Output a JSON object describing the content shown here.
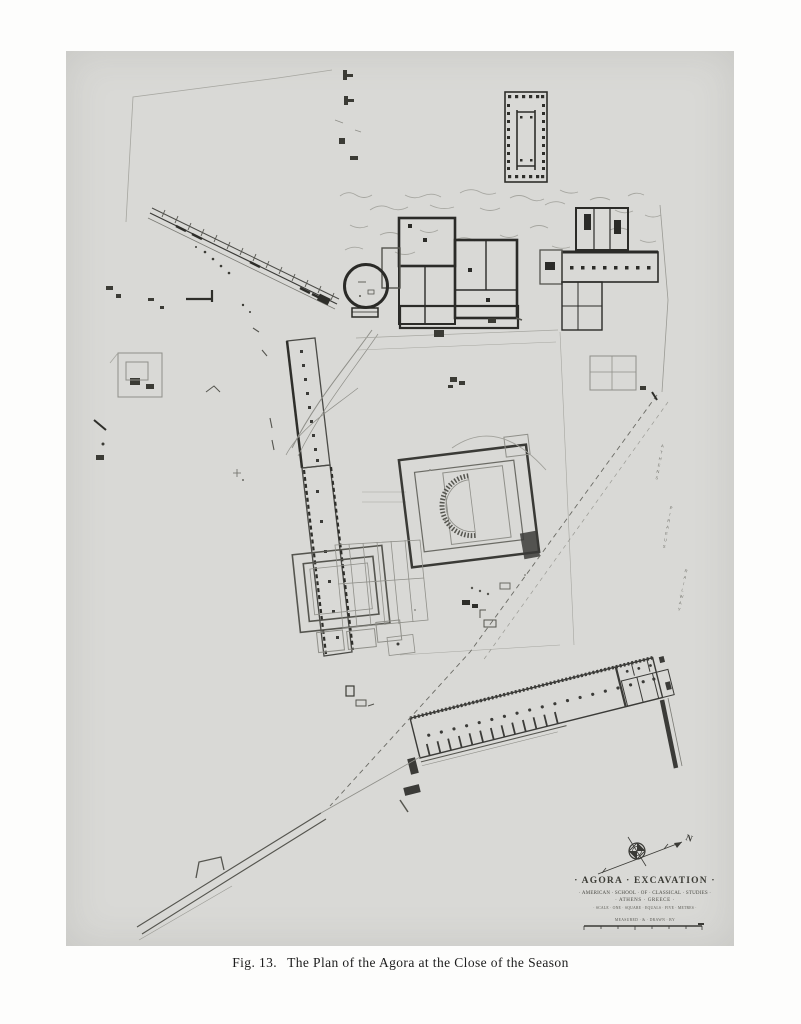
{
  "figure": {
    "fig_label": "Fig. 13.",
    "caption": "The Plan of the Agora at the Close of the Season"
  },
  "title_block": {
    "title": "· AGORA · EXCAVATION ·",
    "institution": "· AMERICAN · SCHOOL · OF · CLASSICAL · STUDIES ·",
    "location": "· ATHENS · GREECE ·",
    "scale_note": "· SCALE · ONE · SQUARE · EQUALS · FIVE · METRES ·",
    "credit": "MEASURED · & · DRAWN · BY"
  },
  "compass": {
    "north_label": "N"
  },
  "street_label": {
    "word1": "ATHENS",
    "word2": "PIRAEUS",
    "word3": "RAILWAY"
  },
  "colors": {
    "page_background": "#fdfdfc",
    "plate_background": "#d9d9d6",
    "ink_dark": "#2e2e2a",
    "ink_mid": "#55554f",
    "ink_light": "#8f8f89",
    "ink_faint": "#a6a6a0"
  }
}
